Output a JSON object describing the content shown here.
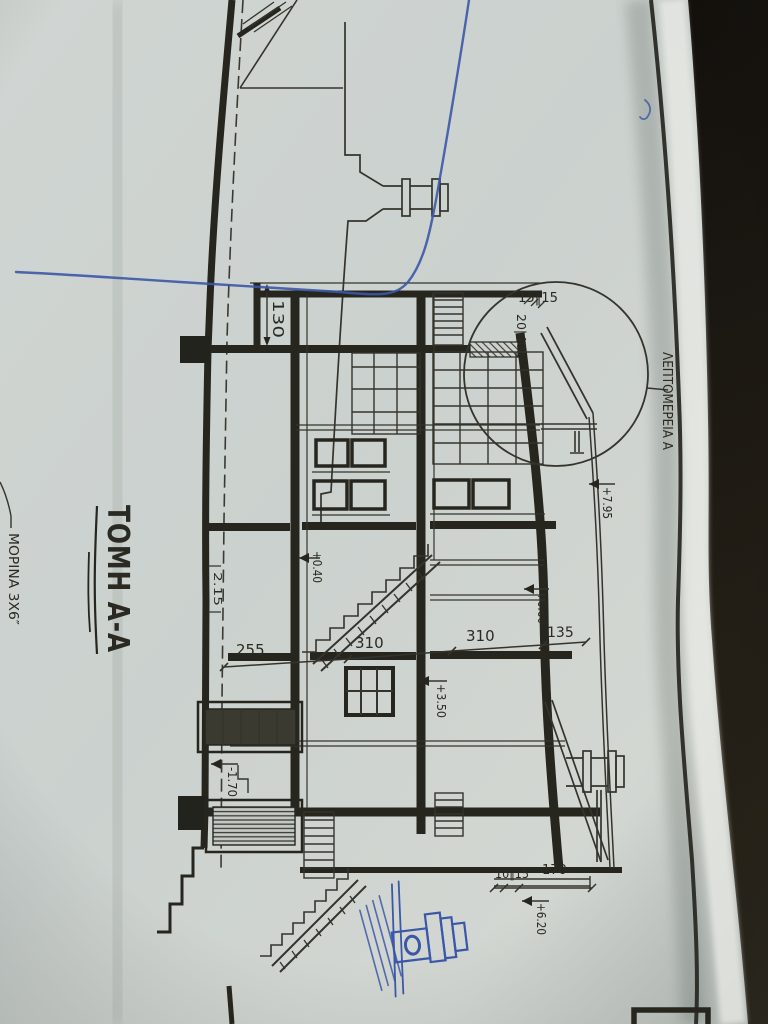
{
  "drawing": {
    "title": "ΤΟΜΗ Α-Α",
    "detail_label": "ΛΕΠΤΟΜΕΡΕΙΑ Α",
    "note_morina": "ΜΟΡΙΝΑ 3Χ6″",
    "dims": {
      "row": [
        "255",
        "310",
        "310",
        "135"
      ],
      "offset": "130",
      "axis": "2.15",
      "eave": "15‖15",
      "rafter": "20|40",
      "base_small": "10‖15",
      "base_long": "170"
    },
    "elevations": {
      "ground_floor": "+0.40",
      "first_floor": "+3.50",
      "roof_main": "+6.60",
      "roof_top": "+7.95",
      "wing_base": "+6.20",
      "basement": "-1.70"
    }
  },
  "colors": {
    "paper": "#ced3d0",
    "ink": "#26261f",
    "blue_pen": "#3b57a8",
    "table": "#16130e"
  }
}
